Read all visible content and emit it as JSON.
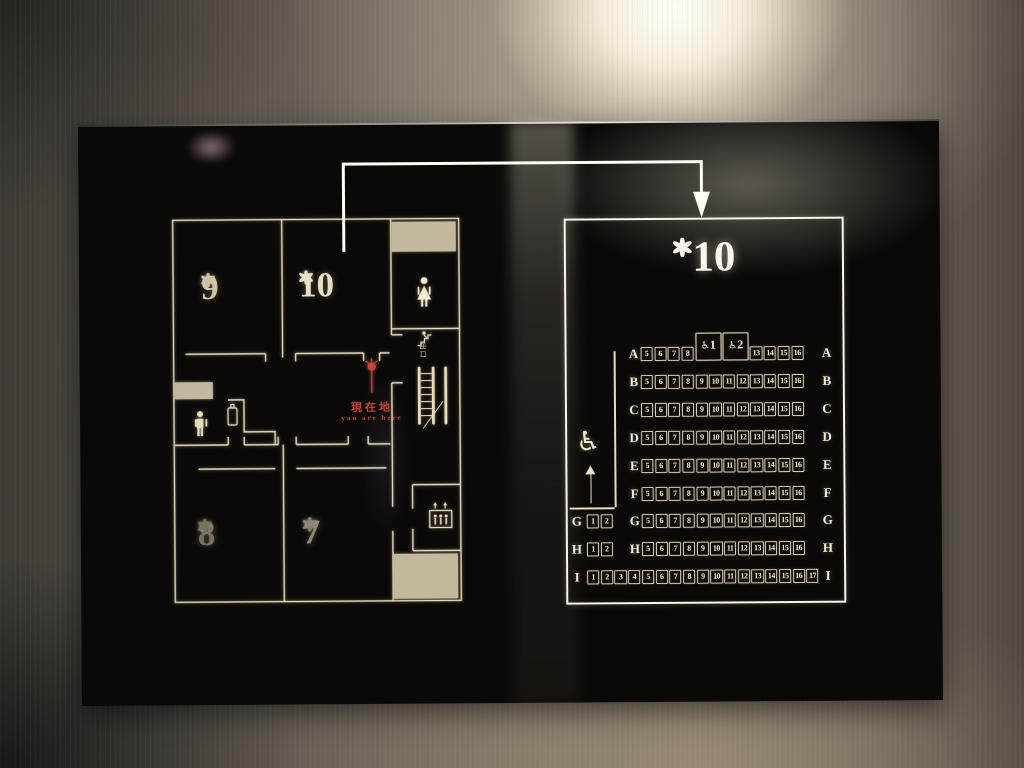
{
  "floorplan": {
    "rooms": [
      {
        "number": "9"
      },
      {
        "number": "10"
      },
      {
        "number": "8"
      },
      {
        "number": "7"
      }
    ],
    "you_are_here": {
      "jp": "現在地",
      "en": "you are here"
    },
    "escalator_exit_label": "出口",
    "icons": [
      "woman-restroom",
      "man-restroom",
      "vending-machine",
      "escalator",
      "elevator"
    ]
  },
  "screen": {
    "title_number": "10",
    "wheelchair_glyph": "♿",
    "rows": [
      {
        "letter": "A",
        "mid_letter": true,
        "seats": [
          {
            "slot": 5,
            "label": "5"
          },
          {
            "slot": 6,
            "label": "6"
          },
          {
            "slot": 7,
            "label": "7"
          },
          {
            "slot": 8,
            "label": "8"
          },
          {
            "slot": 9,
            "label": "1",
            "span": 2,
            "wheelchair": true
          },
          {
            "slot": 11,
            "label": "2",
            "span": 2,
            "wheelchair": true
          },
          {
            "slot": 13,
            "label": "13"
          },
          {
            "slot": 14,
            "label": "14"
          },
          {
            "slot": 15,
            "label": "15"
          },
          {
            "slot": 16,
            "label": "16"
          }
        ]
      },
      {
        "letter": "B",
        "mid_letter": true,
        "seats": [
          {
            "slot": 5,
            "label": "5"
          },
          {
            "slot": 6,
            "label": "6"
          },
          {
            "slot": 7,
            "label": "7"
          },
          {
            "slot": 8,
            "label": "8"
          },
          {
            "slot": 9,
            "label": "9"
          },
          {
            "slot": 10,
            "label": "10"
          },
          {
            "slot": 11,
            "label": "11"
          },
          {
            "slot": 12,
            "label": "12"
          },
          {
            "slot": 13,
            "label": "13"
          },
          {
            "slot": 14,
            "label": "14"
          },
          {
            "slot": 15,
            "label": "15"
          },
          {
            "slot": 16,
            "label": "16"
          }
        ]
      },
      {
        "letter": "C",
        "mid_letter": true,
        "seats": [
          {
            "slot": 5,
            "label": "5"
          },
          {
            "slot": 6,
            "label": "6"
          },
          {
            "slot": 7,
            "label": "7"
          },
          {
            "slot": 8,
            "label": "8"
          },
          {
            "slot": 9,
            "label": "9"
          },
          {
            "slot": 10,
            "label": "10"
          },
          {
            "slot": 11,
            "label": "11"
          },
          {
            "slot": 12,
            "label": "12"
          },
          {
            "slot": 13,
            "label": "13"
          },
          {
            "slot": 14,
            "label": "14"
          },
          {
            "slot": 15,
            "label": "15"
          },
          {
            "slot": 16,
            "label": "16"
          }
        ]
      },
      {
        "letter": "D",
        "mid_letter": true,
        "seats": [
          {
            "slot": 5,
            "label": "5"
          },
          {
            "slot": 6,
            "label": "6"
          },
          {
            "slot": 7,
            "label": "7"
          },
          {
            "slot": 8,
            "label": "8"
          },
          {
            "slot": 9,
            "label": "9"
          },
          {
            "slot": 10,
            "label": "10"
          },
          {
            "slot": 11,
            "label": "11"
          },
          {
            "slot": 12,
            "label": "12"
          },
          {
            "slot": 13,
            "label": "13"
          },
          {
            "slot": 14,
            "label": "14"
          },
          {
            "slot": 15,
            "label": "15"
          },
          {
            "slot": 16,
            "label": "16"
          }
        ]
      },
      {
        "letter": "E",
        "mid_letter": true,
        "seats": [
          {
            "slot": 5,
            "label": "5"
          },
          {
            "slot": 6,
            "label": "6"
          },
          {
            "slot": 7,
            "label": "7"
          },
          {
            "slot": 8,
            "label": "8"
          },
          {
            "slot": 9,
            "label": "9"
          },
          {
            "slot": 10,
            "label": "10"
          },
          {
            "slot": 11,
            "label": "11"
          },
          {
            "slot": 12,
            "label": "12"
          },
          {
            "slot": 13,
            "label": "13"
          },
          {
            "slot": 14,
            "label": "14"
          },
          {
            "slot": 15,
            "label": "15"
          },
          {
            "slot": 16,
            "label": "16"
          }
        ]
      },
      {
        "letter": "F",
        "mid_letter": true,
        "seats": [
          {
            "slot": 5,
            "label": "5"
          },
          {
            "slot": 6,
            "label": "6"
          },
          {
            "slot": 7,
            "label": "7"
          },
          {
            "slot": 8,
            "label": "8"
          },
          {
            "slot": 9,
            "label": "9"
          },
          {
            "slot": 10,
            "label": "10"
          },
          {
            "slot": 11,
            "label": "11"
          },
          {
            "slot": 12,
            "label": "12"
          },
          {
            "slot": 13,
            "label": "13"
          },
          {
            "slot": 14,
            "label": "14"
          },
          {
            "slot": 15,
            "label": "15"
          },
          {
            "slot": 16,
            "label": "16"
          }
        ]
      },
      {
        "letter": "G",
        "left_letter": true,
        "mid_letter": true,
        "left_seats": [
          {
            "slot": 1,
            "label": "1"
          },
          {
            "slot": 2,
            "label": "2"
          }
        ],
        "seats": [
          {
            "slot": 5,
            "label": "5"
          },
          {
            "slot": 6,
            "label": "6"
          },
          {
            "slot": 7,
            "label": "7"
          },
          {
            "slot": 8,
            "label": "8"
          },
          {
            "slot": 9,
            "label": "9"
          },
          {
            "slot": 10,
            "label": "10"
          },
          {
            "slot": 11,
            "label": "11"
          },
          {
            "slot": 12,
            "label": "12"
          },
          {
            "slot": 13,
            "label": "13"
          },
          {
            "slot": 14,
            "label": "14"
          },
          {
            "slot": 15,
            "label": "15"
          },
          {
            "slot": 16,
            "label": "16"
          }
        ]
      },
      {
        "letter": "H",
        "left_letter": true,
        "mid_letter": true,
        "left_seats": [
          {
            "slot": 1,
            "label": "1"
          },
          {
            "slot": 2,
            "label": "2"
          }
        ],
        "seats": [
          {
            "slot": 5,
            "label": "5"
          },
          {
            "slot": 6,
            "label": "6"
          },
          {
            "slot": 7,
            "label": "7"
          },
          {
            "slot": 8,
            "label": "8"
          },
          {
            "slot": 9,
            "label": "9"
          },
          {
            "slot": 10,
            "label": "10"
          },
          {
            "slot": 11,
            "label": "11"
          },
          {
            "slot": 12,
            "label": "12"
          },
          {
            "slot": 13,
            "label": "13"
          },
          {
            "slot": 14,
            "label": "14"
          },
          {
            "slot": 15,
            "label": "15"
          },
          {
            "slot": 16,
            "label": "16"
          }
        ]
      },
      {
        "letter": "I",
        "left_letter": true,
        "mid_letter": false,
        "seats": [
          {
            "slot": 1,
            "label": "1"
          },
          {
            "slot": 2,
            "label": "2"
          },
          {
            "slot": 3,
            "label": "3"
          },
          {
            "slot": 4,
            "label": "4"
          },
          {
            "slot": 5,
            "label": "5"
          },
          {
            "slot": 6,
            "label": "6"
          },
          {
            "slot": 7,
            "label": "7"
          },
          {
            "slot": 8,
            "label": "8"
          },
          {
            "slot": 9,
            "label": "9"
          },
          {
            "slot": 10,
            "label": "10"
          },
          {
            "slot": 11,
            "label": "11"
          },
          {
            "slot": 12,
            "label": "12"
          },
          {
            "slot": 13,
            "label": "13"
          },
          {
            "slot": 14,
            "label": "14"
          },
          {
            "slot": 15,
            "label": "15"
          },
          {
            "slot": 16,
            "label": "16"
          },
          {
            "slot": 17,
            "label": "17"
          }
        ]
      }
    ]
  },
  "colors": {
    "panel_bg": "#0b0907",
    "line_gold": "#e9ddbb",
    "bright_white": "#fdf9ec",
    "tan_fill": "#c4b99c",
    "red_marker": "#d4402e"
  }
}
